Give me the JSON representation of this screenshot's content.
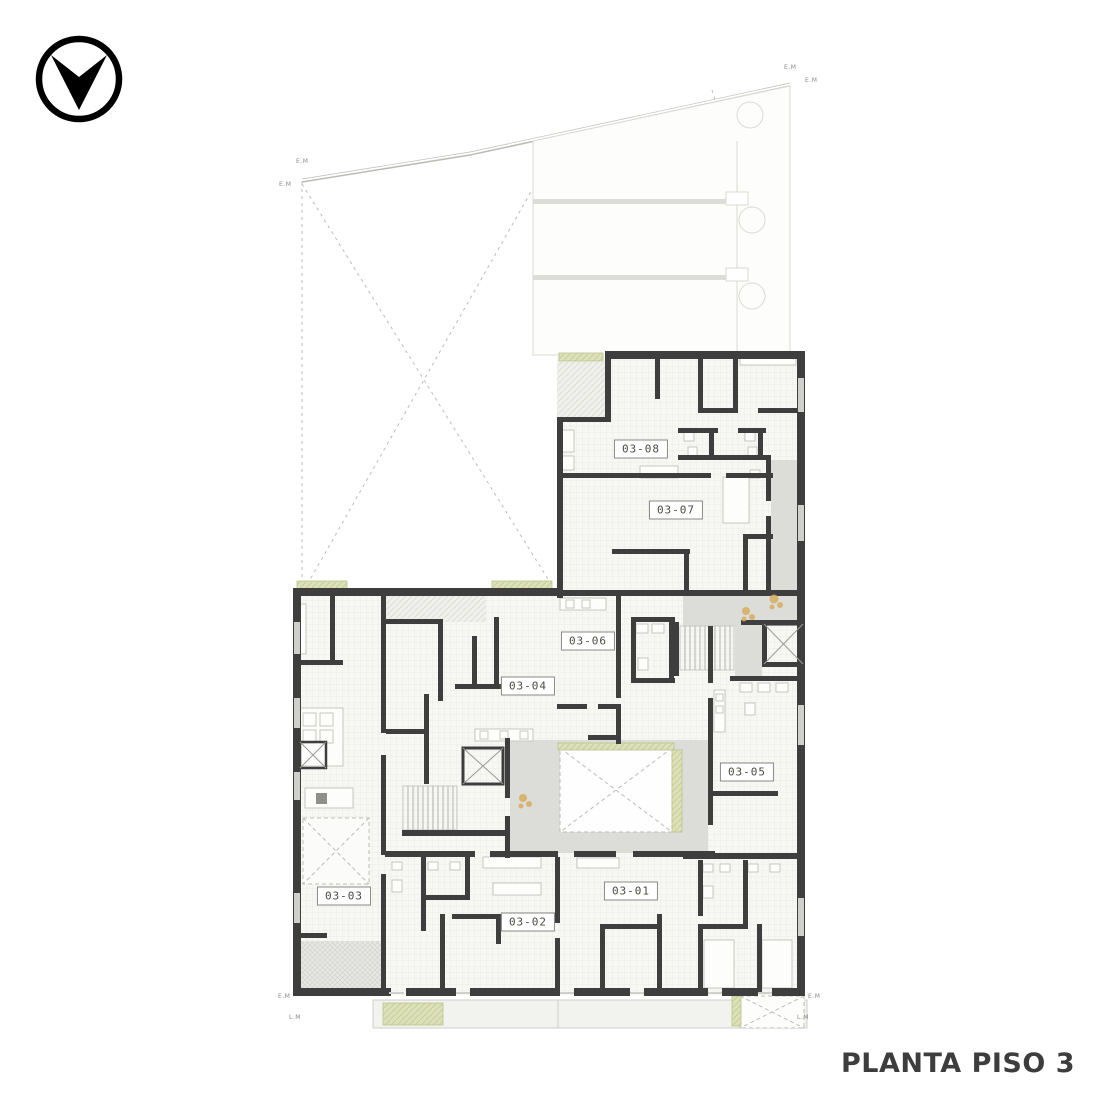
{
  "page": {
    "background": "#ffffff"
  },
  "logo": {
    "icon": "chevron-down-circle-logo",
    "color": "#000000"
  },
  "title": {
    "text": "PLANTA PISO 3"
  },
  "plan": {
    "name": "floor-plan-piso-3",
    "units": [
      {
        "id": "03-01"
      },
      {
        "id": "03-02"
      },
      {
        "id": "03-03"
      },
      {
        "id": "03-04"
      },
      {
        "id": "03-05"
      },
      {
        "id": "03-06"
      },
      {
        "id": "03-07"
      },
      {
        "id": "03-08"
      }
    ],
    "boundary_markers": [
      {
        "label": "E.M"
      },
      {
        "label": "E.M"
      },
      {
        "label": "E.M"
      },
      {
        "label": "E.M"
      },
      {
        "label": "E.M"
      },
      {
        "label": "L.M"
      },
      {
        "label": "E.M"
      },
      {
        "label": "L.M"
      }
    ],
    "colors": {
      "wall": "#3e3e3e",
      "floor": "#f7f7f4",
      "circulation": "#dcdcd8",
      "planter": "#dce1b9",
      "planter_edge": "#b9c48c",
      "plant": "#d8ae62",
      "neighbor": "#d9d9d5",
      "dash": "#bcbcb7",
      "fixture": "#c6c6c2",
      "marker_text": "#8a8a86",
      "title_text": "#3d3d3d"
    }
  }
}
